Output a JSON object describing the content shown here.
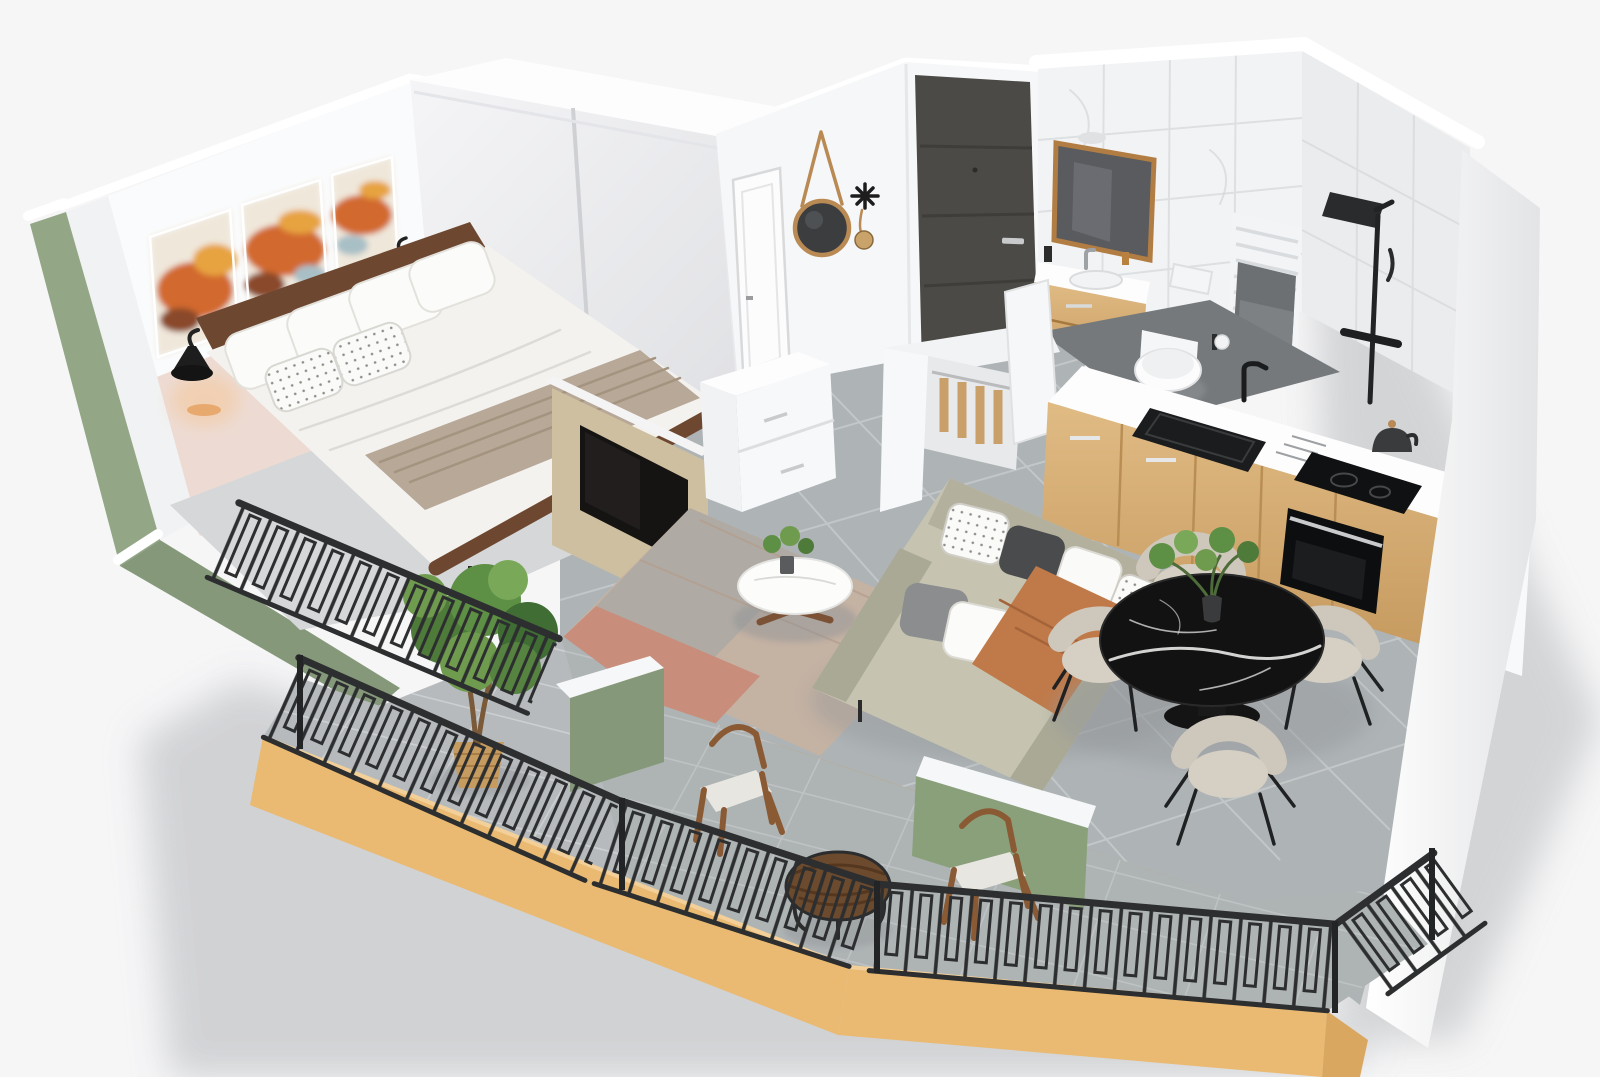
{
  "meta": {
    "type": "3d-floor-plan-render",
    "view": "isometric-cutaway-apartment",
    "description": "Photoreal 3D cutaway floor plan of a one-bedroom apartment with wrap-around balcony"
  },
  "palette": {
    "background": "#ecedee",
    "background_light": "#f6f6f7",
    "cast_shadow": "#c7c9cb",
    "wall_white": "#fafbfc",
    "wall_shade": "#e7e8ea",
    "sage_green": "#93a786",
    "sage_green_dark": "#85997a",
    "blush_wall": "#eddbd3",
    "accent_blush": "#e5cfc8",
    "art_orange": "#d2692f",
    "art_amber": "#e7a33f",
    "art_teal": "#a8bfc6",
    "wood_dark": "#6e4730",
    "oak": "#d7b078",
    "oak_dark": "#bb8f55",
    "floor_tile": "#aeb3b6",
    "floor_grout": "#c6cacc",
    "bath_floor": "#75797c",
    "terrace_tile": "#b6babc",
    "terrace_grout": "#cfd2d3",
    "fascia_yellow": "#eaba72",
    "railing_black": "#2d2e2f",
    "front_door": "#4b4a47",
    "mirror_glass": "#3b3d3f",
    "marble_black": "#121213",
    "marble_vein": "#e9e9e7",
    "chair_cream": "#cec7bc",
    "sofa_greige": "#c6c4b0",
    "sofa_shade": "#aaa996",
    "throw_terracotta": "#c07a49",
    "rug_taupe": "#c4b2a3",
    "rug_pink": "#c98d7c",
    "rug_gray": "#a7a7a3",
    "plant_green": "#5d8f45",
    "plant_green_dark": "#3f6d33",
    "radiator_white": "#f3f4f5",
    "towel_gray": "#6d7073",
    "tv_black": "#161413",
    "tv_panel_khaki": "#cdbf9f",
    "metal_silver": "#c9cacc",
    "frame_tan": "#b98a54",
    "wicker": "#c69b5f",
    "duvet_white": "#f3f2ef",
    "blanket_taupe": "#b7a898"
  },
  "scene": {
    "rooms": [
      {
        "name": "bedroom",
        "items": [
          "double-bed",
          "sliding-wardrobe",
          "art-triptych",
          "wall-sconces",
          "juliet-railing"
        ]
      },
      {
        "name": "hallway",
        "items": [
          "front-door",
          "interior-door",
          "round-strap-mirror",
          "coat-hooks"
        ]
      },
      {
        "name": "bathroom",
        "items": [
          "vanity-mirror",
          "wood-vanity-sink",
          "wall-hung-toilet",
          "towel-radiator",
          "black-shower-column"
        ]
      },
      {
        "name": "kitchen",
        "items": [
          "oak-cabinets",
          "black-sink",
          "induction-hob",
          "built-in-oven",
          "kettle",
          "open-closet"
        ]
      },
      {
        "name": "living-room",
        "items": [
          "greige-sofa",
          "terracotta-throw",
          "round-coffee-table",
          "area-rug",
          "tv-partition",
          "white-dresser"
        ]
      },
      {
        "name": "dining-area",
        "items": [
          "black-marble-table",
          "four-cream-chairs",
          "table-plant"
        ]
      },
      {
        "name": "balcony",
        "items": [
          "metal-railing",
          "yellow-fascia",
          "sage-planter-walls",
          "ficus-tree",
          "two-wood-chairs",
          "round-side-table",
          "sliding-glass-door"
        ]
      }
    ]
  }
}
